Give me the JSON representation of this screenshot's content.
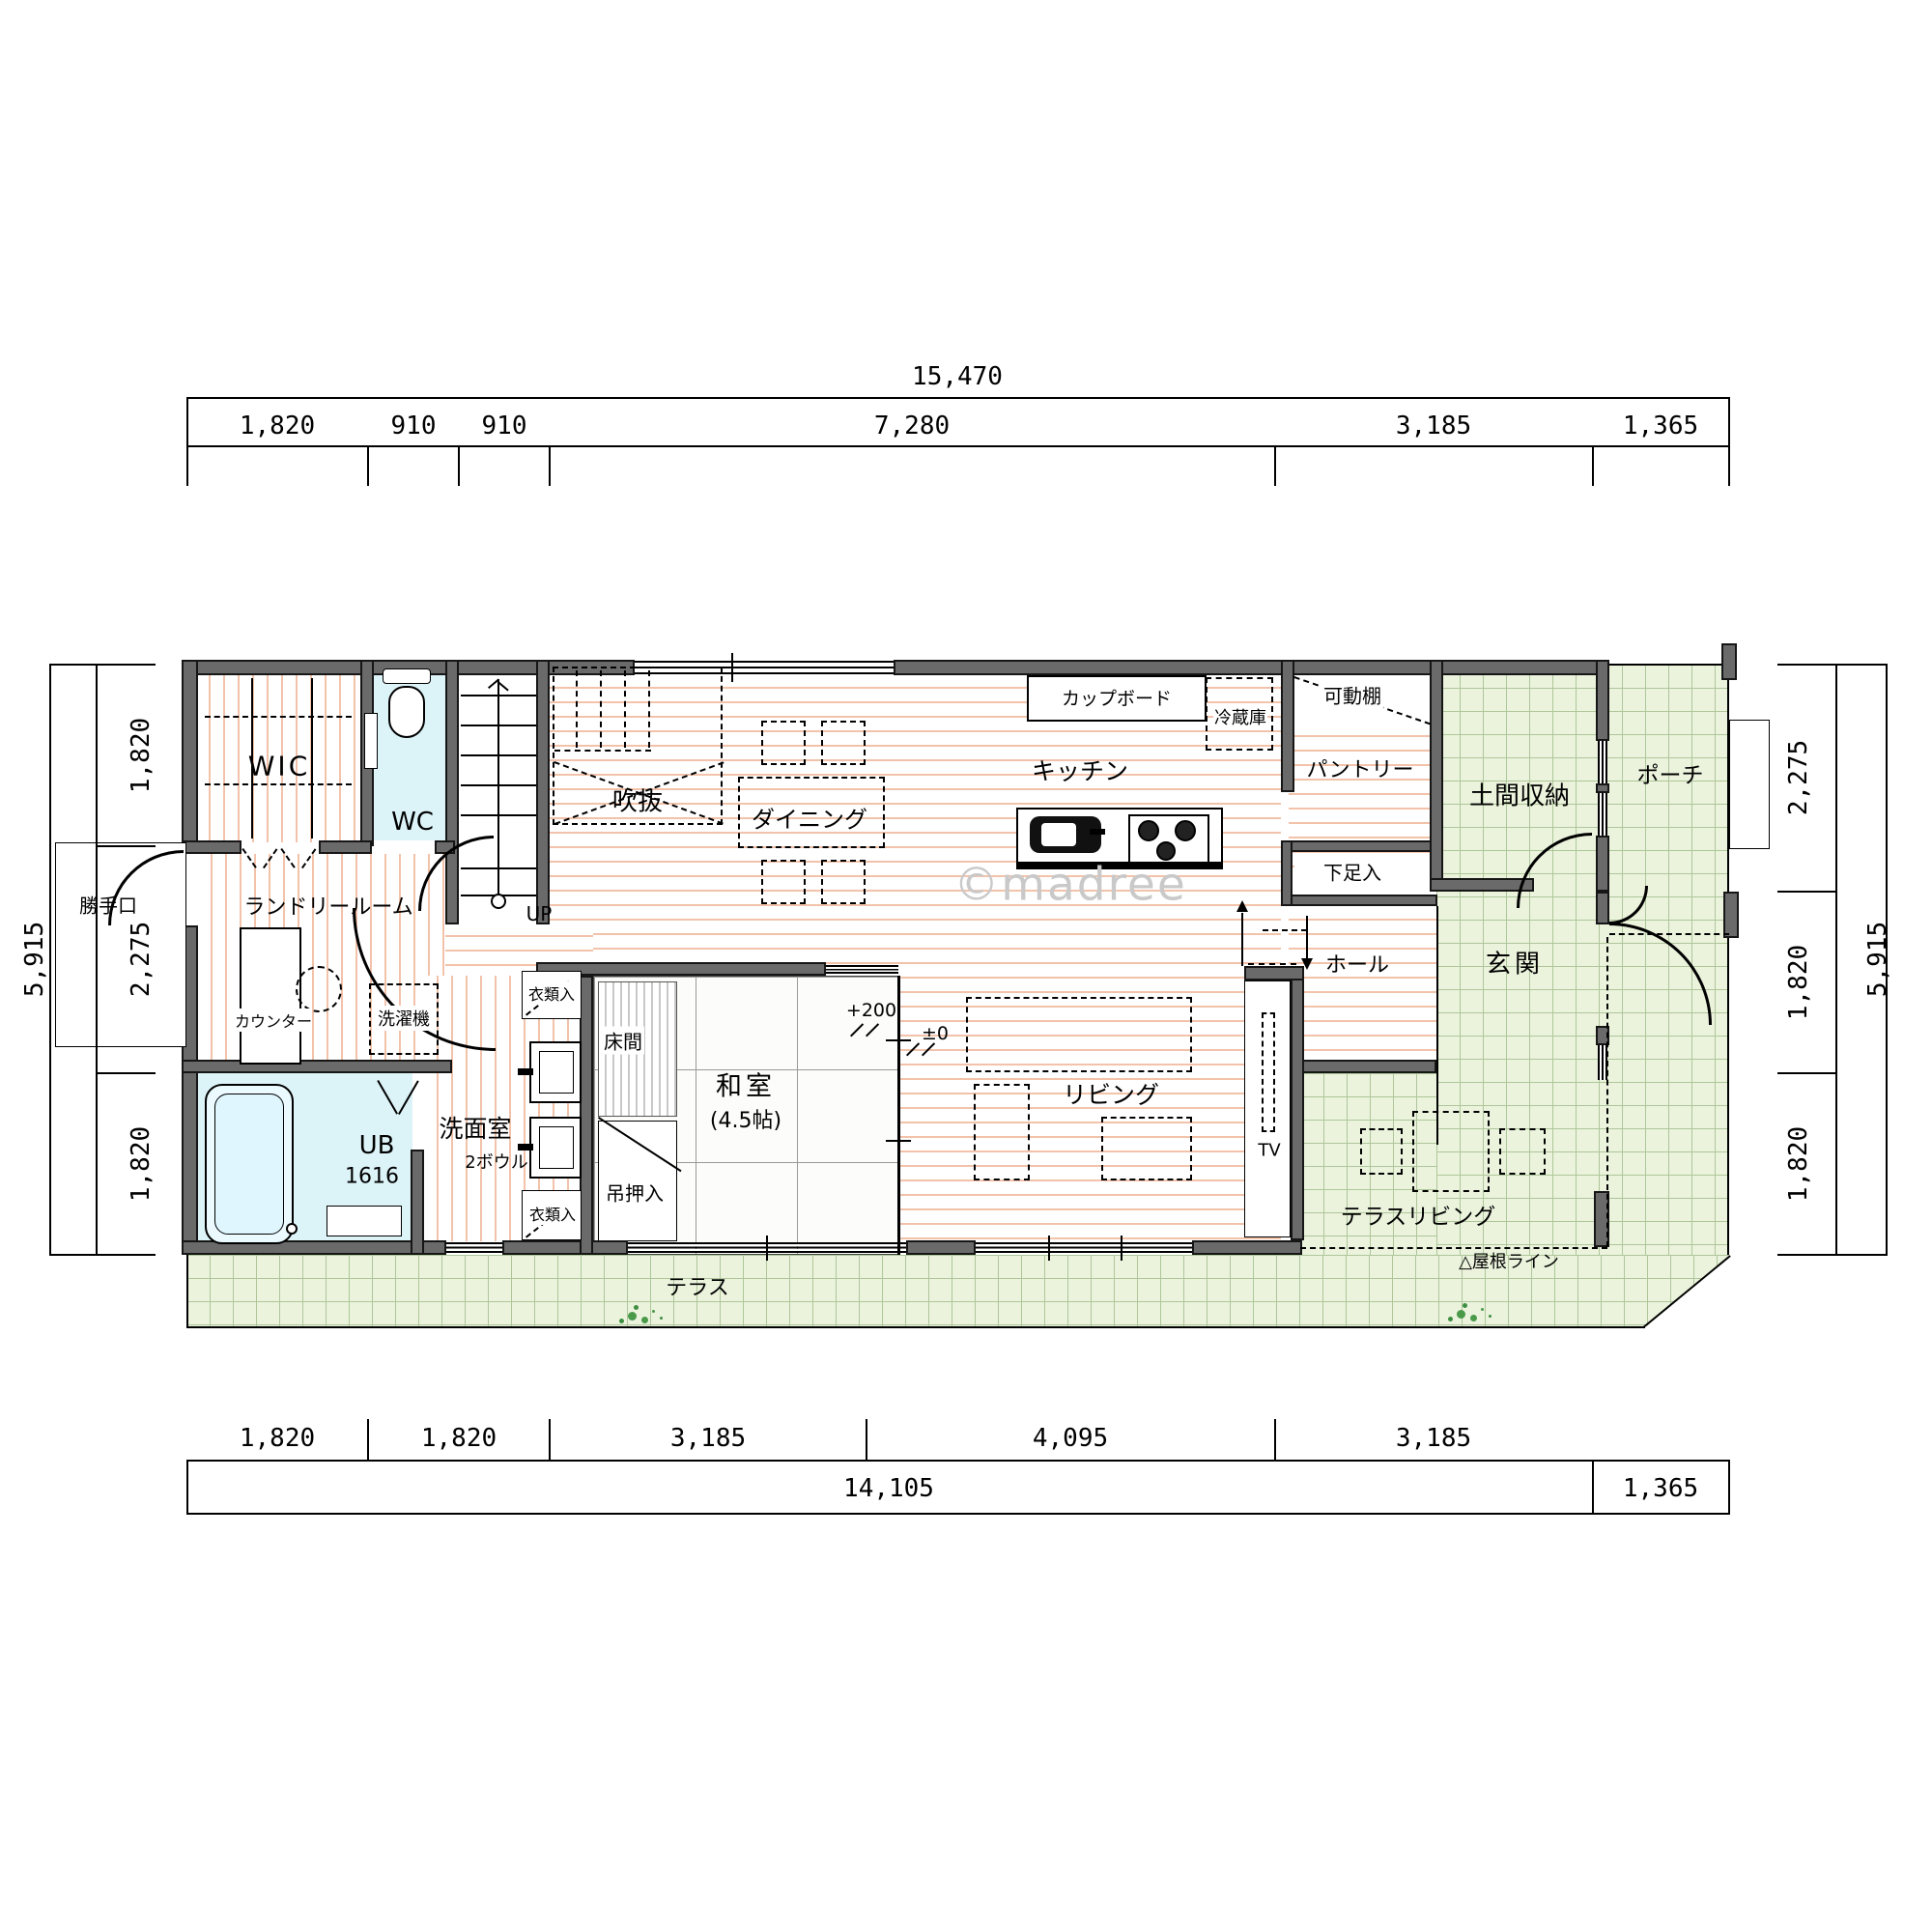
{
  "watermark": "©madree",
  "dims": {
    "top": {
      "total": "15,470",
      "seg": [
        "1,820",
        "910",
        "910",
        "7,280",
        "3,185",
        "1,365"
      ]
    },
    "bottom": {
      "total": "14,105",
      "offset": "1,365",
      "seg": [
        "1,820",
        "1,820",
        "3,185",
        "4,095",
        "3,185"
      ]
    },
    "left": {
      "total": "5,915",
      "seg": [
        "1,820",
        "2,275",
        "1,820"
      ]
    },
    "right": {
      "total": "5,915",
      "seg": [
        "2,275",
        "1,820",
        "1,820"
      ]
    }
  },
  "rooms": {
    "wic": "WIC",
    "wc": "WC",
    "void": "吹抜",
    "dining": "ダイニング",
    "kitchen": "キッチン",
    "pantry": "パントリー",
    "doma": "土間収納",
    "porch": "ポーチ",
    "genkan": "玄関",
    "hall": "ホール",
    "living": "リビング",
    "washitsu": "和室",
    "washitsu_size": "(4.5帖)",
    "tokonoma": "床間",
    "oshiire": "吊押入",
    "laundry": "ランドリールーム",
    "washroom": "洗面室",
    "washroom_bowls": "2ボウル",
    "bath": "UB",
    "bath_size": "1616",
    "terrace_living": "テラスリビング",
    "terrace": "テラス"
  },
  "fixtures": {
    "cupboard": "カップボード",
    "fridge": "冷蔵庫",
    "shelf": "可動棚",
    "shoebox": "下足入",
    "counter": "カウンター",
    "washer": "洗濯機",
    "backdoor": "勝手口",
    "clothes_upper": "衣類入",
    "clothes_lower": "衣類入",
    "tv": "TV",
    "up": "UP",
    "roofline": "△屋根ライン",
    "level_up": "+200",
    "level_zero": "±0"
  },
  "colors": {
    "wall": "#6a6a6a",
    "wood_stripe": "#f2c3aa",
    "tile_green": "#ebf3dd",
    "water_blue": "#dcf3f8"
  }
}
